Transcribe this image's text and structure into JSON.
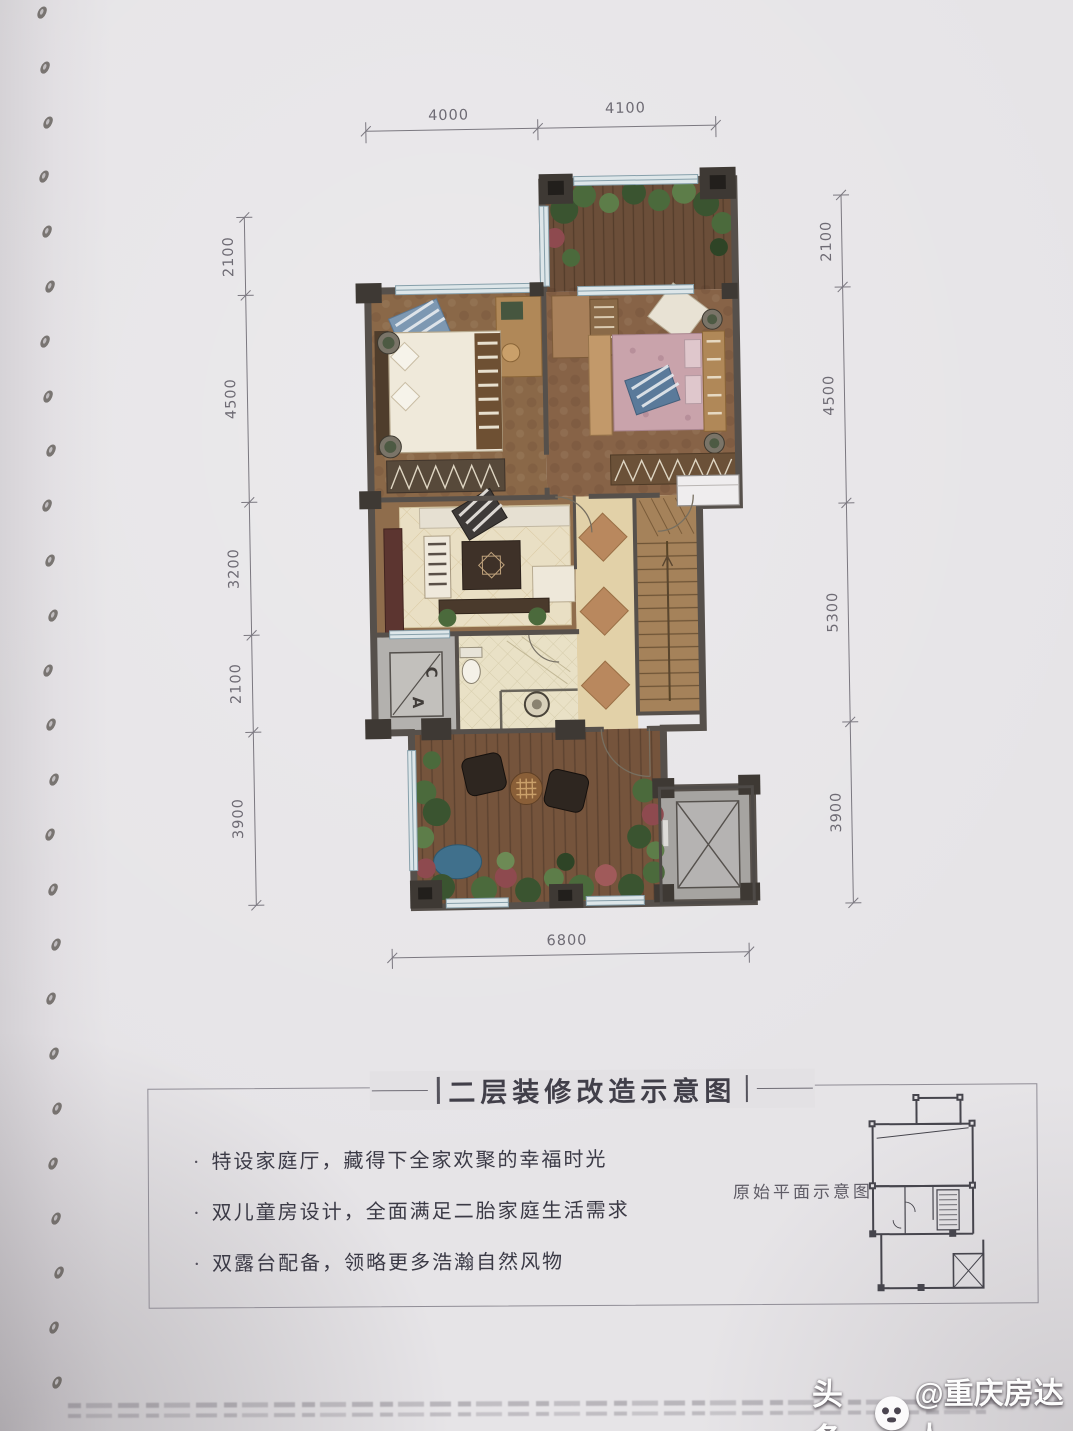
{
  "page": {
    "info_box": {
      "title": "二层装修改造示意图",
      "bullets": [
        {
          "marker": "·",
          "text": "特设家庭厅，藏得下全家欢聚的幸福时光"
        },
        {
          "marker": "·",
          "text": "双儿童房设计，全面满足二胎家庭生活需求"
        },
        {
          "marker": "·",
          "text": "双露台配备，领略更多浩瀚自然风物"
        }
      ],
      "mini_plan_label": "原始平面示意图"
    },
    "floor_plan": {
      "dimensions": {
        "top": [
          "4000",
          "4100"
        ],
        "left": [
          "2100",
          "4500",
          "3200",
          "2100",
          "3900"
        ],
        "right": [
          "2100",
          "4500",
          "5300",
          "3900"
        ],
        "bottom": [
          "6800"
        ]
      },
      "labels": {
        "ac_letter_top": "C",
        "ac_letter_bottom": "A"
      }
    },
    "watermark": {
      "prefix": "头条",
      "handle": "@重庆房达人",
      "icon": "toutiao-face-icon"
    },
    "colors": {
      "paper": "#e4e2e5",
      "wall": "#56504b",
      "window_frame": "#87a0ab",
      "wood_deck": "#75543c",
      "bedroom_floor": "#8a6848",
      "rug_cream": "#e9dfc4",
      "tile_diamond": "#b9885e",
      "plant_green": "#4b6a3c",
      "accent_red": "#8e4a4f",
      "elevator_gray": "#a6a4a1",
      "dimension_text": "#6e6b74"
    }
  }
}
